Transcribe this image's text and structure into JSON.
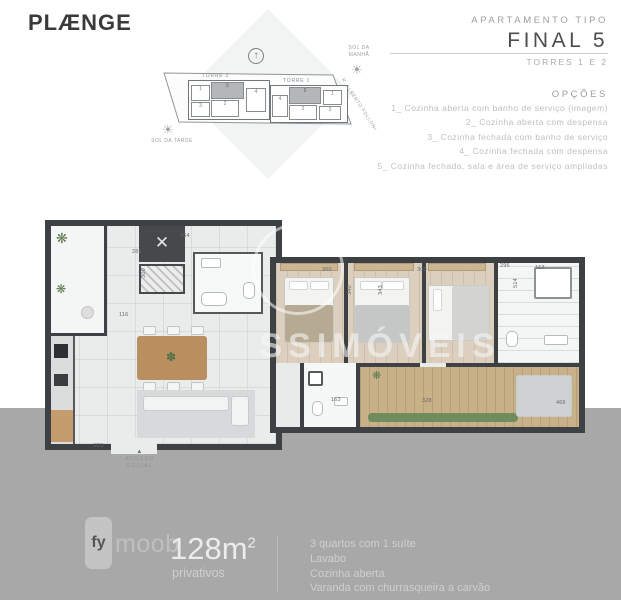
{
  "brand": {
    "logo": "PLÆNGE"
  },
  "header": {
    "kicker": "APARTAMENTO TIPO",
    "title": "FINAL 5",
    "subtitle": "TORRES 1 E 2",
    "options_title": "OPÇÕES",
    "options": [
      "1_ Cozinha aberta com banho de serviço (imagem)",
      "2_ Cozinha aberta com despensa",
      "3_ Cozinha fechada com banho de serviço",
      "4_ Cozinha fechada com despensa",
      "5_ Cozinha fechada, sala e área de serviço ampliadas"
    ]
  },
  "siteplan": {
    "torre2_label": "TORRE 2",
    "torre1_label": "TORRE 1",
    "sun_morning": "SOL DA MANHÃ",
    "sun_afternoon": "SOL DA TARDE",
    "street": "R. ALBERTO FOLLONI",
    "torre2_units": [
      "1",
      "5",
      "4",
      "3",
      "2"
    ],
    "torre1_units": [
      "5",
      "1",
      "4",
      "2",
      "3"
    ]
  },
  "plan": {
    "watermark": "SSIMÓVEIS",
    "entry_line1": "ACESSO",
    "entry_line2": "SOCIAL",
    "entry_arrow": "▲",
    "elevator_mark": "✕",
    "dimensions": [
      "364",
      "281",
      "300",
      "116",
      "221",
      "300",
      "340",
      "300",
      "343",
      "296",
      "514",
      "163",
      "163",
      "328",
      "466"
    ]
  },
  "footer": {
    "logo_fy": "fy",
    "logo_moob": "moob",
    "area_base": "128m",
    "area_exp": "2",
    "area_label": "privativos",
    "features": [
      "3 quartos com 1 suíte",
      "Lavabo",
      "Cozinha aberta",
      "Varanda com churrasqueira a carvão"
    ]
  },
  "colors": {
    "footer_bg": "#a8a8a8",
    "wall": "#3e4144",
    "wood": "#c59c6e",
    "deck": "#c8b089"
  }
}
